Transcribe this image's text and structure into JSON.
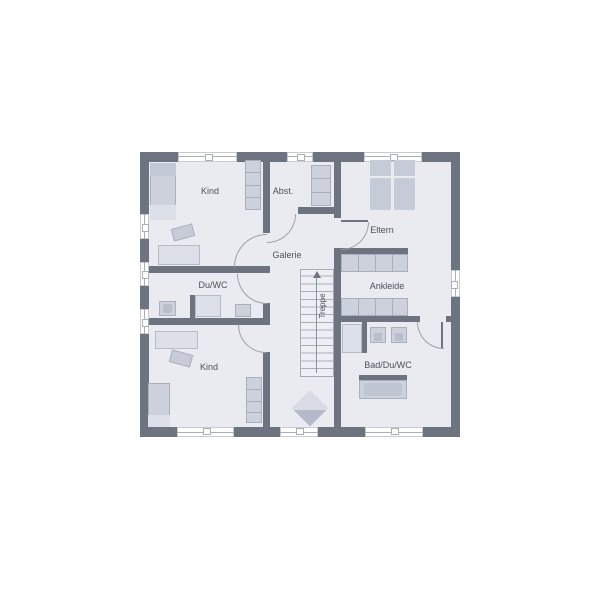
{
  "plan": {
    "rooms": {
      "kind_top": "Kind",
      "abst": "Abst.",
      "eltern": "Eltern",
      "galerie": "Galerie",
      "du_wc": "Du/WC",
      "ankleide": "Ankleide",
      "treppe": "Treppe",
      "kind_bottom": "Kind",
      "bad_du_wc": "Bad/Du/WC"
    },
    "colors": {
      "background": "#ffffff",
      "floor": "#e9ebf1",
      "wall": "#6d7480",
      "furniture": "#ccd1dc",
      "furniture_dark": "#b8bfcb",
      "furniture_light": "#dde0e8",
      "line": "#a9afb9",
      "text": "#4c515a"
    }
  }
}
